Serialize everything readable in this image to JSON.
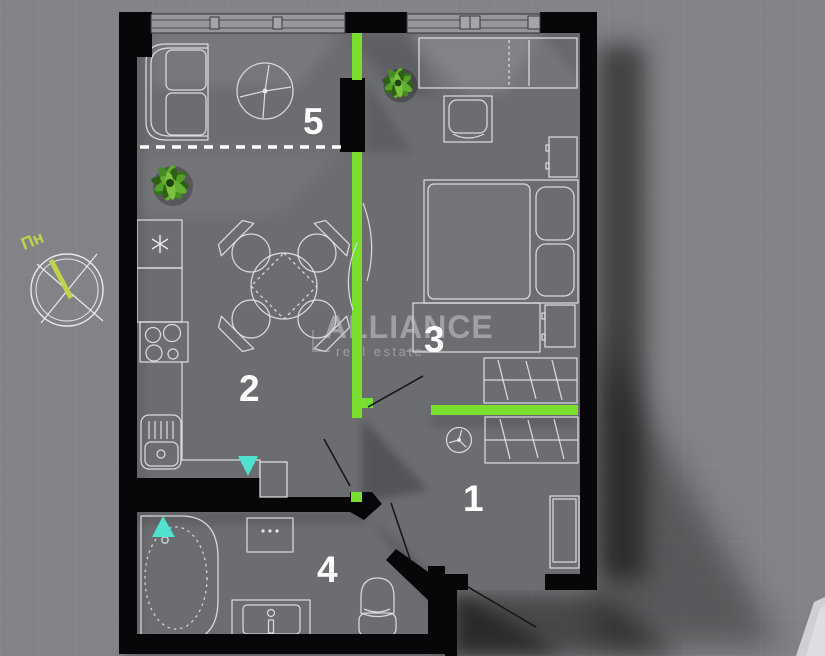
{
  "brand": {
    "name": "ALLIANCE",
    "tagline": "real estate"
  },
  "compass": {
    "label": "Пн"
  },
  "rooms": {
    "hallway": {
      "number": "1"
    },
    "kitchen_living": {
      "number": "2"
    },
    "bedroom": {
      "number": "3"
    },
    "bathroom": {
      "number": "4"
    },
    "balcony": {
      "number": "5"
    }
  },
  "colors": {
    "background": "#828387",
    "floor": "#6c6d71",
    "wall": "#070709",
    "accent_green": "#7ade2f",
    "marker_teal": "#4fe3cf",
    "compass_green": "#c3d24b",
    "furniture_outline": "#e3e4e7"
  }
}
